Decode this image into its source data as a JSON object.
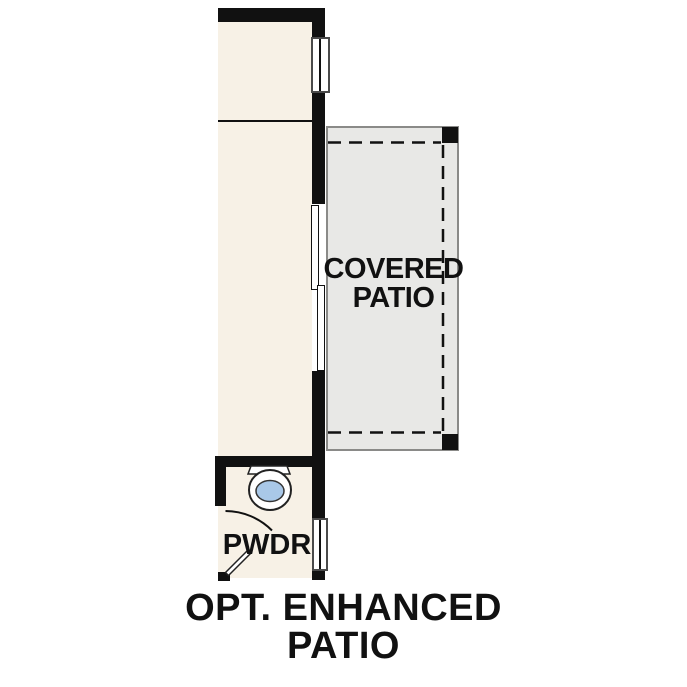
{
  "colors": {
    "background": "#FFFFFF",
    "room_fill": "#F7F1E6",
    "patio_fill": "#E8E8E6",
    "patio_border": "#8A8A88",
    "wall": "#111111",
    "window_frame": "#4A4A4A",
    "toilet_water": "#A9C8E8",
    "text": "#111111"
  },
  "patio": {
    "label_line1": "COVERED",
    "label_line2": "PATIO"
  },
  "powder_room": {
    "label": "PWDR"
  },
  "caption": {
    "line1": "OPT. ENHANCED",
    "line2": "PATIO"
  }
}
